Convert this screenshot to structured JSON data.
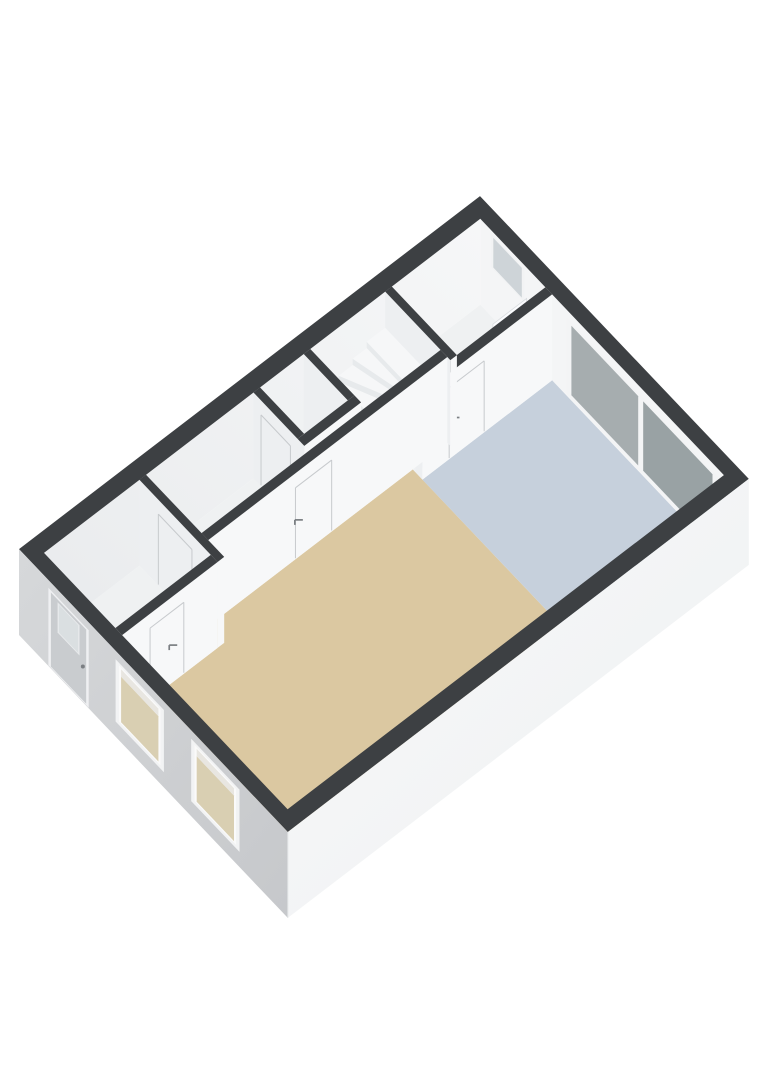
{
  "scene": {
    "kind": "3d-floorplan-render",
    "background": "#ffffff",
    "view": "isometric-top-oblique"
  },
  "palette": {
    "wall_top": "#3d4043",
    "wall_face_u": "#f7f8f9",
    "wall_face_v": "#edeff1",
    "inner_back_face": "#f4f5f6",
    "inner_left_light": "#f6f7f8",
    "inner_left_dark": "#e9ebed",
    "exterior_front_light": "#d6d8da",
    "exterior_front_dark": "#c6c8cb",
    "exterior_right_light": "#f8f9fa",
    "exterior_right_dark": "#eef0f1",
    "floor_living": "#dbc8a1",
    "floor_bedroom": "#c6d0dc",
    "floor_white": "#eff1f2",
    "stair_top": "#f6f7f8",
    "stair_riser": "#e7eaec",
    "stair_side": "#e2e5e8",
    "seam": "#c7cacd",
    "handle": "#7b7f83",
    "door_slab": "#c9cccf",
    "door_frame": "#eff0f2",
    "door_glass": "#dadfe1",
    "window_frame": "#f2f3f4",
    "window_glass_floorview": "#d9cfb2",
    "window_glass_top": "#e8e6e1",
    "slider_frame": "#f3f4f5",
    "slider_glass_left": "#a6adaf",
    "slider_glass_right": "#99a2a4",
    "small_window_glass": "#ced4d8",
    "toilet_seat": "#7d4038",
    "panel_white": "#fafbfd"
  },
  "building": {
    "width_m": 6.4,
    "length_m": 11.2,
    "wall_height_m": 2.55,
    "exterior_wall_m": 0.3,
    "interior_wall_m": 0.16
  },
  "rooms": [
    {
      "id": "living-room",
      "floor_color": "floor_living",
      "poly": [
        [
          1.78,
          3.45
        ],
        [
          6.1,
          3.45
        ],
        [
          6.1,
          10.9
        ],
        [
          2.16,
          10.9
        ],
        [
          2.16,
          8.58
        ],
        [
          1.78,
          8.58
        ]
      ]
    },
    {
      "id": "bedroom",
      "floor_color": "floor_bedroom",
      "poly": [
        [
          2.01,
          0.3
        ],
        [
          6.1,
          0.3
        ],
        [
          6.1,
          3.45
        ],
        [
          2.01,
          3.45
        ]
      ]
    },
    {
      "id": "front-room",
      "floor_color": "floor_white",
      "poly": [
        [
          0.3,
          0.3
        ],
        [
          1.85,
          0.3
        ],
        [
          1.85,
          2.45
        ],
        [
          0.3,
          2.45
        ]
      ]
    },
    {
      "id": "hall",
      "floor_color": "floor_white",
      "poly": [
        [
          0.3,
          2.61
        ],
        [
          1.85,
          2.61
        ],
        [
          1.85,
          3.45
        ],
        [
          1.62,
          3.45
        ],
        [
          1.62,
          8.42
        ],
        [
          0.3,
          8.42
        ]
      ]
    },
    {
      "id": "wc",
      "floor_color": "floor_white",
      "poly": [
        [
          0.3,
          4.59
        ],
        [
          1.35,
          4.59
        ],
        [
          1.35,
          5.65
        ],
        [
          0.3,
          5.65
        ]
      ]
    },
    {
      "id": "entry",
      "floor_color": "floor_white",
      "poly": [
        [
          0.3,
          8.58
        ],
        [
          2.0,
          8.58
        ],
        [
          2.0,
          10.9
        ],
        [
          0.3,
          10.9
        ]
      ]
    }
  ],
  "interior_walls": [
    {
      "id": "wall-frontroom-bedroom",
      "axis": "u",
      "at": [
        1.85,
        2.01
      ],
      "span": [
        0.3,
        3.45
      ],
      "cap_end": true,
      "doors": [
        {
          "span": [
            1.95,
            2.8
          ],
          "handle": 2.55
        }
      ]
    },
    {
      "id": "wall-frontroom-hall",
      "axis": "v",
      "at": [
        2.45,
        2.61
      ],
      "span": [
        0.3,
        1.85
      ],
      "cap_end": true,
      "doors": []
    },
    {
      "id": "wall-wc-north",
      "axis": "v",
      "at": [
        4.43,
        4.59
      ],
      "span": [
        0.3,
        1.35
      ],
      "cap_end": false,
      "doors": []
    },
    {
      "id": "wall-wc-east",
      "axis": "u",
      "at": [
        1.35,
        1.51
      ],
      "span": [
        4.43,
        5.81
      ],
      "cap_end": true,
      "doors": []
    },
    {
      "id": "wall-wc-south",
      "axis": "v",
      "at": [
        5.65,
        5.81
      ],
      "span": [
        0.3,
        1.35
      ],
      "cap_end": false,
      "doors": [
        {
          "span": [
            0.48,
            1.18
          ],
          "handle": 1.04
        }
      ]
    },
    {
      "id": "wall-hall-living",
      "axis": "u",
      "at": [
        1.62,
        1.78
      ],
      "span": [
        2.61,
        8.42
      ],
      "cap_end": true,
      "doors": [
        {
          "span": [
            5.42,
            6.3
          ],
          "handle": 6.12
        }
      ]
    },
    {
      "id": "wall-hall-entry",
      "axis": "v",
      "at": [
        8.42,
        8.58
      ],
      "span": [
        0.3,
        2.16
      ],
      "cap_end": true,
      "doors": [
        {
          "span": [
            0.75,
            1.55
          ],
          "handle": 1.41
        }
      ]
    },
    {
      "id": "wall-entry-living",
      "axis": "u",
      "at": [
        2.0,
        2.16
      ],
      "span": [
        8.58,
        10.9
      ],
      "cap_end": false,
      "doors": [
        {
          "span": [
            9.4,
            10.22
          ],
          "handle": 9.56
        }
      ]
    }
  ],
  "back_wall_openings": [
    {
      "id": "window-front-room",
      "type": "window",
      "u": [
        0.55,
        1.35
      ],
      "z": [
        1.45,
        2.45
      ]
    },
    {
      "id": "sliding-door-bedroom",
      "type": "sliding-door",
      "u": [
        2.35,
        5.95
      ],
      "z": [
        0.05,
        2.32
      ],
      "panes": [
        [
          2.47,
          4.06
        ],
        [
          4.18,
          5.83
        ]
      ],
      "pane_z": [
        0.16,
        2.22
      ]
    }
  ],
  "front_wall_openings": [
    {
      "id": "front-door",
      "type": "door",
      "u": [
        0.7,
        1.66
      ],
      "z": [
        0.02,
        2.32
      ],
      "glass_u": [
        0.95,
        1.41
      ],
      "glass_z": [
        1.32,
        2.14
      ],
      "handle_z": 1.06
    },
    {
      "id": "window-living-1",
      "type": "window",
      "u": [
        2.3,
        3.45
      ],
      "z": [
        0.45,
        2.3
      ]
    },
    {
      "id": "window-living-2",
      "type": "window",
      "u": [
        4.1,
        5.25
      ],
      "z": [
        0.45,
        2.3
      ]
    }
  ],
  "stairs": {
    "id": "staircase",
    "u": [
      0.3,
      1.56
    ],
    "landing": {
      "v": [
        2.61,
        3.06
      ],
      "z": 1.48
    },
    "winders": [
      {
        "poly": [
          [
            0.3,
            3.06
          ],
          [
            1.56,
            3.06
          ],
          [
            0.3,
            3.4
          ]
        ],
        "z": 1.295,
        "edge": [
          [
            1.56,
            3.06
          ],
          [
            0.3,
            3.4
          ]
        ]
      },
      {
        "poly": [
          [
            0.3,
            3.4
          ],
          [
            1.56,
            3.06
          ],
          [
            0.3,
            3.74
          ]
        ],
        "z": 1.11,
        "edge": [
          [
            1.56,
            3.06
          ],
          [
            0.3,
            3.74
          ]
        ]
      },
      {
        "poly": [
          [
            0.3,
            3.74
          ],
          [
            1.56,
            3.06
          ],
          [
            1.56,
            3.74
          ]
        ],
        "z": 0.925,
        "edge": [
          [
            0.3,
            3.74
          ],
          [
            1.56,
            3.74
          ]
        ],
        "side_v": [
          3.06,
          3.74
        ]
      }
    ],
    "straight": [
      {
        "v": [
          3.74,
          3.98
        ],
        "z": 0.74
      },
      {
        "v": [
          3.98,
          4.22
        ],
        "z": 0.555
      },
      {
        "v": [
          4.22,
          4.43
        ],
        "z": 0.37
      }
    ]
  },
  "fixtures": {
    "toilet": {
      "id": "toilet",
      "tank": {
        "u": [
          0.78,
          1.14
        ],
        "v": [
          5.42,
          5.6
        ],
        "h": 0.75
      },
      "bowl": {
        "u": [
          0.82,
          1.1
        ],
        "v": [
          5.06,
          5.42
        ],
        "h": 0.42
      },
      "seat_inset": {
        "u": [
          0.86,
          1.06
        ],
        "v": [
          5.1,
          5.38
        ]
      }
    },
    "open_door_panel": {
      "id": "open-door-front-room",
      "u": 1.6,
      "v": [
        0.5,
        1.32
      ],
      "h": 2.08
    },
    "ledge_front_room": {
      "id": "ledge-front-room",
      "u": [
        0.45,
        1.05
      ],
      "v": [
        2.05,
        2.35
      ],
      "h": 0.72
    }
  }
}
